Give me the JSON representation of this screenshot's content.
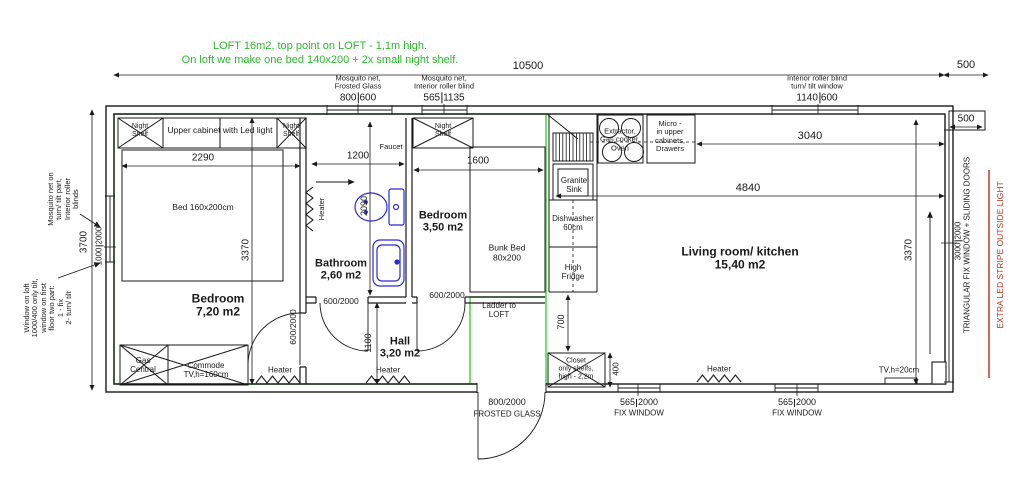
{
  "notes": {
    "line1": "LOFT 16m2, top point on LOFT - 1,1m high.",
    "line2": "On loft we make one bed 140x200 + 2x small night shelf."
  },
  "dims": {
    "total": "10500",
    "ext_right": "500",
    "corner": "500",
    "bedroom_w": "2290",
    "bath_w": "1200",
    "bedroom2_w": "1600",
    "kitchen_run": "3040",
    "living_w": "4840",
    "left_h": "3700",
    "bedroom_h": "3370",
    "right_h": "3370",
    "toilet": "2090",
    "hall_h": "1100",
    "gap": "700",
    "closet": "400"
  },
  "windows": {
    "top_a": {
      "l1": "Mosquito net,",
      "l2": "Frosted Glass",
      "w": "800",
      "h": "600"
    },
    "top_b": {
      "l1": "Mosquito net,",
      "l2": "Interior roller blind",
      "w": "565",
      "h": "1135"
    },
    "top_c": {
      "l1": "Interior roller blind",
      "l2": "turn/ tilt window",
      "w": "1140",
      "h": "600"
    },
    "left": {
      "w": "1000",
      "h": "2000"
    },
    "right": {
      "w": "3000",
      "h": "2000"
    },
    "fix1": {
      "w": "565",
      "h": "2000",
      "label": "FIX WINDOW"
    },
    "fix2": {
      "w": "565",
      "h": "2000",
      "label": "FIX WINDOW"
    },
    "entry": {
      "size": "800/2000",
      "label": "FROSTED GLASS"
    }
  },
  "doors": {
    "interior": "600/2000"
  },
  "side_notes": {
    "mosquito": [
      "Mosquito net on",
      "turn/ tilt part,",
      "Interior roller",
      "blinds"
    ],
    "window_loft": [
      "Window on loft",
      "1000/400 only tilt,",
      "window on first",
      "floor two part:",
      "1 - fix",
      "2- turn/ tilt"
    ],
    "triangular": "TRIANGULAR FIX WINDOW + SLIDING DOORS",
    "led": "EXTRA LED STRIPE OUTSIDE LIGHT"
  },
  "rooms": {
    "bedroom1": {
      "name": "Bedroom",
      "area": "7,20 m2"
    },
    "bathroom": {
      "name": "Bathroom",
      "area": "2,60 m2"
    },
    "bedroom2": {
      "name": "Bedroom",
      "area": "3,50 m2"
    },
    "hall": {
      "name": "Hall",
      "area": "3,20 m2"
    },
    "living": {
      "name": "Living room/ kitchen",
      "area": "15,40 m2"
    }
  },
  "fixtures": {
    "night_shelf": [
      "Night",
      "Shelf"
    ],
    "upper_cabinet": "Upper cabinet with Led light",
    "bed": "Bed 160x200cm",
    "bunk_bed": [
      "Bunk Bed",
      "80x200"
    ],
    "gas_central": [
      "Gas",
      "Central"
    ],
    "commode": [
      "Commode",
      "TV,h=160cm"
    ],
    "heater": "Heater",
    "faucet": "Faucet",
    "granite_sink": [
      "Granite",
      "Sink"
    ],
    "dishwasher": [
      "Dishwasher",
      "60cm"
    ],
    "fridge": [
      "High",
      "Fridge"
    ],
    "extractor": [
      "Extractor,",
      "Gas cooker,",
      "Oven"
    ],
    "micro": [
      "Micro -",
      "in upper",
      "cabinets,",
      "Drawers"
    ],
    "ladder": [
      "Ladder to",
      "LOFT"
    ],
    "closet": [
      "Closet",
      "only shelfs,",
      "high - 2,2m"
    ],
    "tv": "TV,h=20cm"
  },
  "colors": {
    "loft_outline": "#3ecc3e",
    "note_text": "#2eb82e",
    "led_stripe": "#c0392b",
    "plumbing": "#2b2bd0",
    "line": "#1a1a1a"
  }
}
